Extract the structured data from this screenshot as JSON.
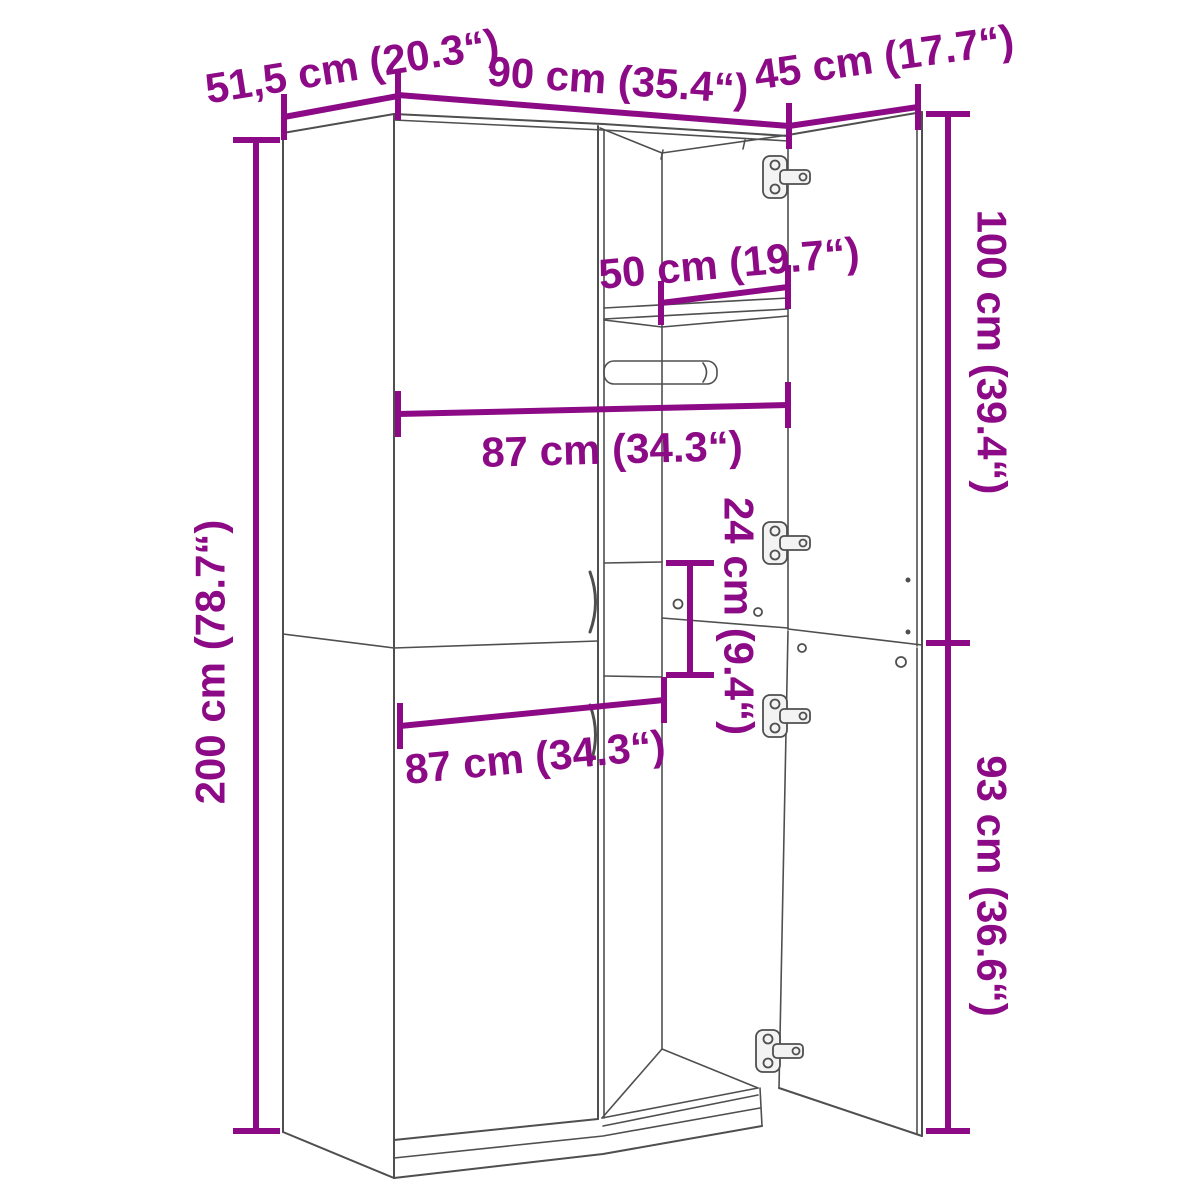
{
  "colors": {
    "dimension_accent": "#8C0A86",
    "drawing_line": "#4F4F4F",
    "background": "#FFFFFF"
  },
  "diagram": {
    "subject": "wardrobe-dimension-diagram",
    "dims": {
      "depth_top": {
        "label": "51,5 cm (20.3“)"
      },
      "width_top": {
        "label": "90 cm (35.4“)"
      },
      "door_width_top": {
        "label": "45 cm (17.7“)"
      },
      "inner_width_top": {
        "label": "50 cm (19.7“)"
      },
      "inner_width_upper": {
        "label": "87 cm (34.3“)"
      },
      "middle_height": {
        "label": "24 cm (9.4“)"
      },
      "total_height": {
        "label": "200 cm (78.7“)"
      },
      "upper_door_height": {
        "label": "100 cm (39.4“)"
      },
      "lower_door_height": {
        "label": "93 cm (36.6“)"
      },
      "inner_width_lower": {
        "label": "87 cm (34.3“)"
      }
    }
  }
}
